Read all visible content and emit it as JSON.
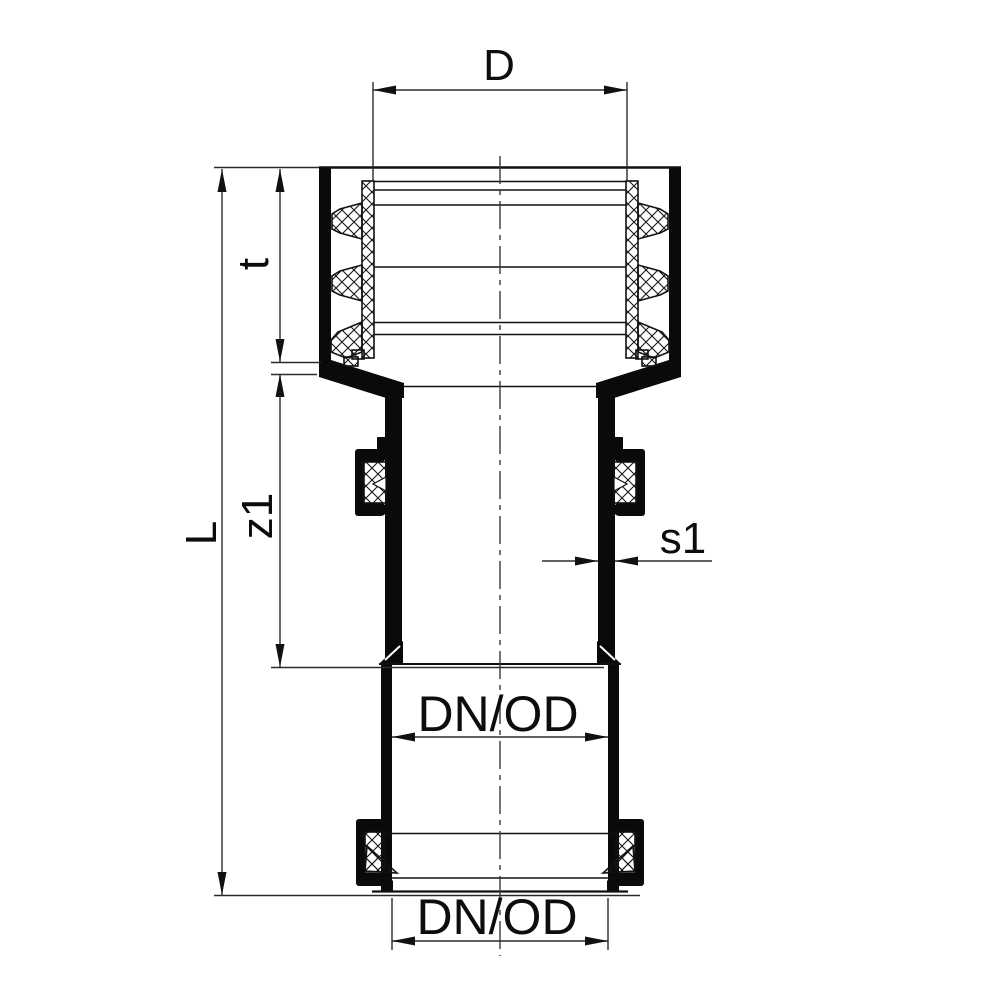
{
  "drawing": {
    "kind": "technical-drawing",
    "subject": "pipe fitting cross-section with ribbed socket seal, external seal rings and dimension annotations",
    "background": "#ffffff",
    "colors": {
      "outline": "#0a0a0a",
      "dimension_line": "#2b2b2b",
      "hatch": "#161616",
      "text": "#0d0d0d"
    },
    "dimension_labels": {
      "socket_diameter": "D",
      "socket_depth": "t",
      "spigot_length": "z1",
      "overall_length": "L",
      "wall_thickness": "s1",
      "bore_upper": "DN/OD",
      "bore_lower": "DN/OD"
    }
  }
}
